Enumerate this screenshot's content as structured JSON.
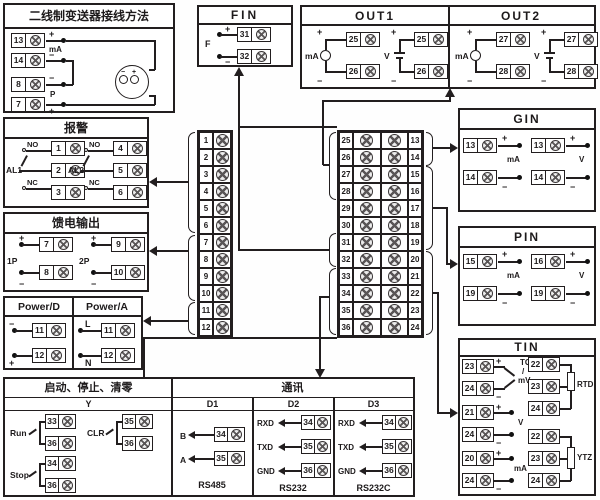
{
  "symbols": {
    "plus": "+",
    "minus": "−"
  },
  "strip_left": [
    "1",
    "2",
    "3",
    "4",
    "5",
    "6",
    "7",
    "8",
    "9",
    "10",
    "11",
    "12"
  ],
  "strip_right_left": [
    "25",
    "26",
    "27",
    "28",
    "29",
    "30",
    "31",
    "32",
    "33",
    "34",
    "35",
    "36"
  ],
  "strip_right_right": [
    "13",
    "14",
    "15",
    "16",
    "17",
    "18",
    "19",
    "20",
    "21",
    "22",
    "23",
    "24"
  ],
  "transmitter": {
    "title": "二线制变送器接线方法",
    "t1": "13",
    "t2": "14",
    "t3": "8",
    "t4": "7",
    "label_ma": "mA",
    "label_p": "P"
  },
  "alarm": {
    "title": "报警",
    "g1": {
      "label": "AL1",
      "no": "NO",
      "nc": "NC",
      "t1": "1",
      "t2": "2",
      "t3": "3"
    },
    "g2": {
      "label": "AL2",
      "no": "NO",
      "nc": "NC",
      "t1": "4",
      "t2": "5",
      "t3": "6"
    }
  },
  "feed": {
    "title": "馈电输出",
    "g1": {
      "label": "1P",
      "tp": "7",
      "tm": "8"
    },
    "g2": {
      "label": "2P",
      "tp": "9",
      "tm": "10"
    }
  },
  "power": {
    "d": {
      "title": "Power/D",
      "l1": "−",
      "t1": "11",
      "l2": "+",
      "t2": "12"
    },
    "a": {
      "title": "Power/A",
      "l1": "L",
      "t1": "11",
      "l2": "N",
      "t2": "12"
    }
  },
  "fin": {
    "title": "FIN",
    "label": "F",
    "tp": "31",
    "tm": "32"
  },
  "out1": {
    "title": "OUT1",
    "ma": {
      "label": "mA",
      "tp": "25",
      "tm": "26"
    },
    "v": {
      "label": "V",
      "tp": "25",
      "tm": "26"
    }
  },
  "out2": {
    "title": "OUT2",
    "ma": {
      "label": "mA",
      "tp": "27",
      "tm": "28"
    },
    "v": {
      "label": "V",
      "tp": "27",
      "tm": "28"
    }
  },
  "gin": {
    "title": "GIN",
    "ma": {
      "label": "mA",
      "tp": "13",
      "tm": "14"
    },
    "v": {
      "label": "V",
      "tp": "13",
      "tm": "14"
    }
  },
  "pin": {
    "title": "PIN",
    "ma": {
      "label": "mA",
      "tp": "15",
      "tm": "19"
    },
    "v": {
      "label": "V",
      "tp": "16",
      "tm": "19"
    }
  },
  "tin": {
    "title": "TIN",
    "tc": {
      "l1": "TC",
      "l2": "/",
      "l3": "mV",
      "tp": "23",
      "tm": "24"
    },
    "v": {
      "label": "V",
      "tp": "21",
      "tm": "24"
    },
    "ma": {
      "label": "mA",
      "tp": "20",
      "tm": "24"
    },
    "rtd": {
      "label": "RTD",
      "t1": "22",
      "t2": "23",
      "t3": "24"
    },
    "ytz": {
      "label": "YTZ",
      "t1": "22",
      "t2": "23",
      "t3": "24"
    }
  },
  "control": {
    "title": "启动、停止、清零",
    "comm_title": "通讯",
    "col_y": "Y",
    "col_d1": "D1",
    "col_d2": "D2",
    "col_d3": "D3",
    "run": {
      "label": "Run",
      "t1": "33",
      "t2": "36"
    },
    "stop": {
      "label": "Stop",
      "t1": "34",
      "t2": "36"
    },
    "clr": {
      "label": "CLR",
      "t1": "35",
      "t2": "36"
    },
    "d1": {
      "r1": {
        "label": "B",
        "t": "34"
      },
      "r2": {
        "label": "A",
        "t": "35"
      },
      "footer": "RS485"
    },
    "d2": {
      "r1": {
        "label": "RXD",
        "t": "34"
      },
      "r2": {
        "label": "TXD",
        "t": "35"
      },
      "r3": {
        "label": "GND",
        "t": "36"
      },
      "footer": "RS232"
    },
    "d3": {
      "r1": {
        "label": "RXD",
        "t": "34"
      },
      "r2": {
        "label": "TXD",
        "t": "35"
      },
      "r3": {
        "label": "GND",
        "t": "36"
      },
      "footer": "RS232C"
    }
  }
}
